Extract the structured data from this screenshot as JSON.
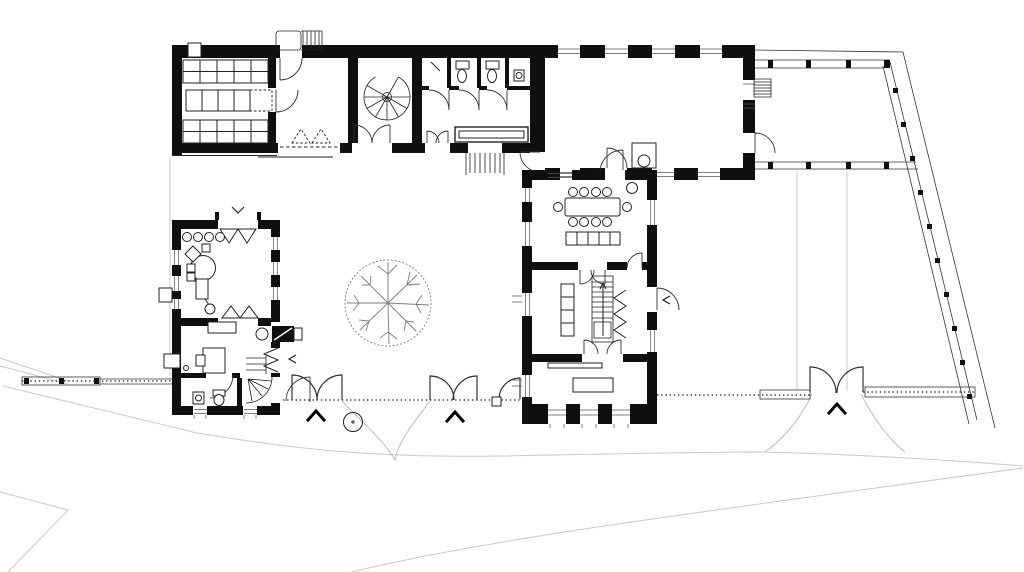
{
  "document": {
    "type": "Architectural ground-floor plan",
    "description": "Black-and-white line drawing of a farmhouse courtyard complex: an L-shaped north wing (storage room with shelving, spiral stair, WC block, corridor, large empty hall), an east pergola along a diagonal plot boundary, a two-storey dining/kitchen wing, a small free-standing atelier building, a walled courtyard with a tree, three double gates on the southern boundary wall and light terrain contour lines.",
    "visible_text": []
  },
  "canvas": {
    "width": 1024,
    "height": 572,
    "background": "#ffffff"
  },
  "colors": {
    "background": "#ffffff",
    "wall": "#0f0f0f",
    "line": "#222222",
    "door_arc": "#333333",
    "glazing": "#555555",
    "terrain": "#c9c9c9",
    "driveway": "#bdbdbd",
    "tree": "#7d7d7d"
  },
  "buildings": [
    {
      "name": "north-wing",
      "rooms": [
        "storage-room-with-shelf-grid",
        "entry-vestibule",
        "spiral-stair-hall",
        "wc-block-3-stalls",
        "corridor-with-counter"
      ],
      "symbols": [
        "shelf-grid-3-bands",
        "dashed-reserved-rectangle",
        "exterior-entry-stair-north",
        "spiral-staircase",
        "double-door-swings",
        "toilets",
        "wash-basin",
        "long-counter",
        "courtyard-exit-stair",
        "dashed-canopy-edge-with-triangles"
      ]
    },
    {
      "name": "hall-wing",
      "rooms": [
        "large-empty-hall"
      ],
      "symbols": [
        "pier-and-window-walls",
        "stove-with-circle",
        "door-swings",
        "small-exterior-stair-east"
      ]
    },
    {
      "name": "dining-wing",
      "rooms": [
        "dining-room",
        "kitchen-with-stair",
        "south-room"
      ],
      "symbols": [
        "dining-table",
        "ten-chairs",
        "sideboard-5-cells",
        "kitchen-counter-4-cells",
        "straight-stair-with-arrow",
        "zigzag-stair-symbol",
        "rug-table",
        "window-sills"
      ]
    },
    {
      "name": "atelier-building",
      "rooms": [
        "workshop-room",
        "study-room",
        "bathroom",
        "winder-stair-corner"
      ],
      "symbols": [
        "round-work-table",
        "four-stools",
        "desk-with-chair",
        "fireplace-with-flue",
        "folding-shutter-zigzag",
        "toilet",
        "wash-basin",
        "quarter-winder-stair",
        "open-shutter-triangles"
      ]
    }
  ],
  "site": {
    "tree": {
      "shape": "plan-tree-symbol",
      "center_x": 388,
      "center_y": 303,
      "radius": 43
    },
    "drain_circle": {
      "center_x": 353,
      "center_y": 422,
      "radius": 10
    },
    "gates": {
      "count": 4,
      "double_leaf": 3,
      "single_leaf": 1
    },
    "gate_direction_chevrons": 3,
    "small_chevrons": 3,
    "boundary": [
      "south-wall-with-dotted-line",
      "west-fence-band-with-posts",
      "east-pergola-band-with-posts",
      "diagonal-north-east-boundary",
      "terrain-contour-lines"
    ]
  }
}
